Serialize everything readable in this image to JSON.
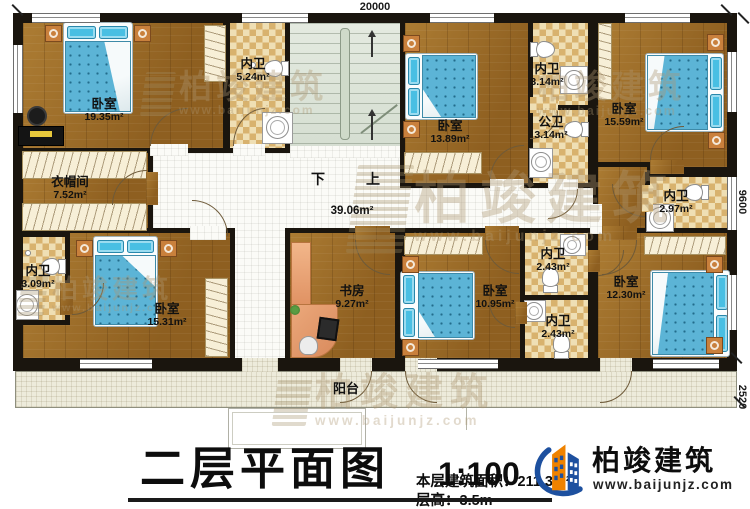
{
  "plan": {
    "dimensions": {
      "top": "20000",
      "right_upper": "9600",
      "right_lower": "2520"
    },
    "stairs": {
      "down": "下",
      "up": "上"
    },
    "corridor_area": "39.06m²",
    "rooms": [
      {
        "name": "卧室",
        "area": "19.35m²"
      },
      {
        "name": "内卫",
        "area": "5.24m²"
      },
      {
        "name": "卧室",
        "area": "13.89m²"
      },
      {
        "name": "内卫",
        "area": "3.14m²"
      },
      {
        "name": "公卫",
        "area": "3.14m²"
      },
      {
        "name": "卧室",
        "area": "15.59m²"
      },
      {
        "name": "内卫",
        "area": "2.97m²"
      },
      {
        "name": "衣帽间",
        "area": "7.52m²"
      },
      {
        "name": "内卫",
        "area": "3.09m²"
      },
      {
        "name": "卧室",
        "area": "15.31m²"
      },
      {
        "name": "书房",
        "area": "9.27m²"
      },
      {
        "name": "卧室",
        "area": "10.95m²"
      },
      {
        "name": "内卫",
        "area": "2.43m²"
      },
      {
        "name": "内卫",
        "area": "2.43m²"
      },
      {
        "name": "卧室",
        "area": "12.30m²"
      },
      {
        "name": "阳台"
      }
    ]
  },
  "titleblock": {
    "title": "二层平面图",
    "scale": "1:100",
    "area_line": "本层建筑面积：211.3m²",
    "floor_height_line": "层高：3.5m"
  },
  "brand": {
    "name": "柏竣建筑",
    "url": "www.baijunjz.com"
  }
}
